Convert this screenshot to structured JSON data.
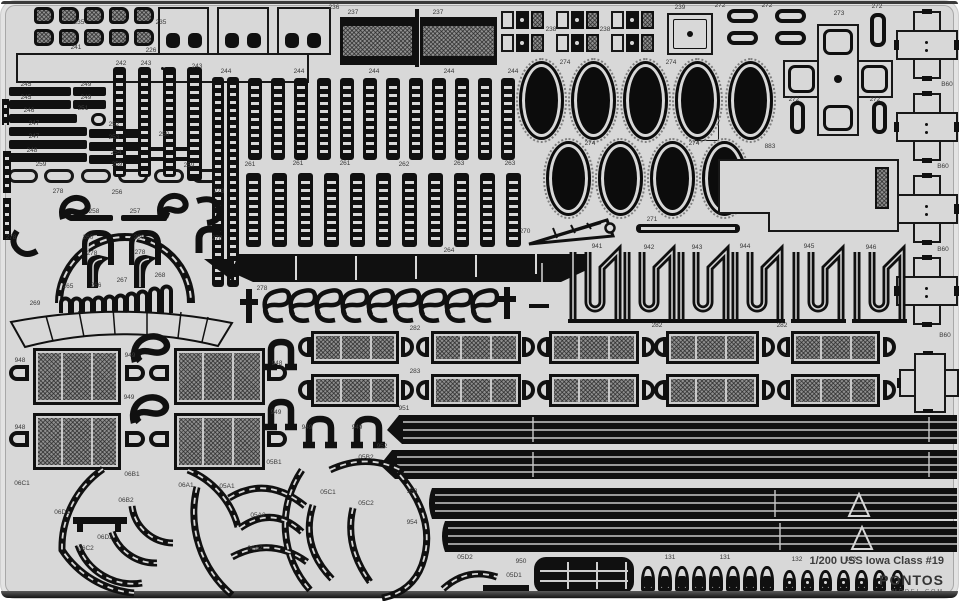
{
  "sheet": {
    "title": "1/200 USS Iowa Class #19",
    "brand": "PONTOS",
    "brand_sub": "MODEL.COM",
    "bg_color": "#d8d8d8",
    "part_color": "#101010",
    "mesh_color": "#8f8f8f"
  },
  "labels": [
    {
      "t": "235",
      "x": 78,
      "y": 22
    },
    {
      "t": "235",
      "x": 160,
      "y": 22
    },
    {
      "t": "226",
      "x": 150,
      "y": 50
    },
    {
      "t": "241",
      "x": 75,
      "y": 47
    },
    {
      "t": "236",
      "x": 333,
      "y": 7
    },
    {
      "t": "237",
      "x": 352,
      "y": 12
    },
    {
      "t": "237",
      "x": 437,
      "y": 12
    },
    {
      "t": "238",
      "x": 550,
      "y": 29
    },
    {
      "t": "238",
      "x": 604,
      "y": 29
    },
    {
      "t": "239",
      "x": 679,
      "y": 7
    },
    {
      "t": "272",
      "x": 719,
      "y": 5
    },
    {
      "t": "272",
      "x": 766,
      "y": 5
    },
    {
      "t": "272",
      "x": 876,
      "y": 6
    },
    {
      "t": "273",
      "x": 838,
      "y": 13
    },
    {
      "t": "272",
      "x": 793,
      "y": 99
    },
    {
      "t": "272",
      "x": 874,
      "y": 99
    },
    {
      "t": "B60",
      "x": 946,
      "y": 84
    },
    {
      "t": "B60",
      "x": 942,
      "y": 166
    },
    {
      "t": "B60",
      "x": 942,
      "y": 249
    },
    {
      "t": "B60",
      "x": 944,
      "y": 335
    },
    {
      "t": "274",
      "x": 564,
      "y": 62
    },
    {
      "t": "274",
      "x": 670,
      "y": 62
    },
    {
      "t": "274",
      "x": 589,
      "y": 143
    },
    {
      "t": "274",
      "x": 693,
      "y": 143
    },
    {
      "t": "883",
      "x": 769,
      "y": 146
    },
    {
      "t": "242",
      "x": 120,
      "y": 63
    },
    {
      "t": "243",
      "x": 145,
      "y": 63
    },
    {
      "t": "243",
      "x": 196,
      "y": 66
    },
    {
      "t": "244",
      "x": 225,
      "y": 71
    },
    {
      "t": "244",
      "x": 298,
      "y": 71
    },
    {
      "t": "244",
      "x": 373,
      "y": 71
    },
    {
      "t": "244",
      "x": 448,
      "y": 71
    },
    {
      "t": "244",
      "x": 512,
      "y": 71
    },
    {
      "t": "245",
      "x": 25,
      "y": 84
    },
    {
      "t": "249",
      "x": 85,
      "y": 84
    },
    {
      "t": "245",
      "x": 25,
      "y": 97
    },
    {
      "t": "249",
      "x": 85,
      "y": 97
    },
    {
      "t": "246",
      "x": 28,
      "y": 110
    },
    {
      "t": "251",
      "x": 82,
      "y": 108
    },
    {
      "t": "247",
      "x": 33,
      "y": 123
    },
    {
      "t": "252",
      "x": 113,
      "y": 124
    },
    {
      "t": "247",
      "x": 33,
      "y": 136
    },
    {
      "t": "253",
      "x": 113,
      "y": 137
    },
    {
      "t": "248",
      "x": 31,
      "y": 150
    },
    {
      "t": "254",
      "x": 115,
      "y": 152
    },
    {
      "t": "250",
      "x": 163,
      "y": 134
    },
    {
      "t": "259",
      "x": 40,
      "y": 164
    },
    {
      "t": "259",
      "x": 116,
      "y": 164
    },
    {
      "t": "259",
      "x": 188,
      "y": 165
    },
    {
      "t": "261",
      "x": 249,
      "y": 164
    },
    {
      "t": "261",
      "x": 297,
      "y": 163
    },
    {
      "t": "261",
      "x": 344,
      "y": 163
    },
    {
      "t": "262",
      "x": 403,
      "y": 164
    },
    {
      "t": "263",
      "x": 458,
      "y": 163
    },
    {
      "t": "263",
      "x": 509,
      "y": 163
    },
    {
      "t": "256",
      "x": 116,
      "y": 192
    },
    {
      "t": "257",
      "x": 134,
      "y": 211
    },
    {
      "t": "258",
      "x": 93,
      "y": 211
    },
    {
      "t": "260",
      "x": 87,
      "y": 237
    },
    {
      "t": "260",
      "x": 138,
      "y": 237
    },
    {
      "t": "278",
      "x": 57,
      "y": 191
    },
    {
      "t": "278",
      "x": 218,
      "y": 191
    },
    {
      "t": "278",
      "x": 10,
      "y": 237
    },
    {
      "t": "278",
      "x": 216,
      "y": 238
    },
    {
      "t": "278",
      "x": 91,
      "y": 253
    },
    {
      "t": "278",
      "x": 139,
      "y": 252
    },
    {
      "t": "278",
      "x": 261,
      "y": 288
    },
    {
      "t": "265",
      "x": 67,
      "y": 286
    },
    {
      "t": "266",
      "x": 95,
      "y": 285
    },
    {
      "t": "267",
      "x": 121,
      "y": 280
    },
    {
      "t": "268",
      "x": 159,
      "y": 275
    },
    {
      "t": "269",
      "x": 34,
      "y": 303
    },
    {
      "t": "264",
      "x": 448,
      "y": 250
    },
    {
      "t": "270",
      "x": 524,
      "y": 231
    },
    {
      "t": "271",
      "x": 651,
      "y": 219
    },
    {
      "t": "941",
      "x": 596,
      "y": 246
    },
    {
      "t": "942",
      "x": 648,
      "y": 247
    },
    {
      "t": "943",
      "x": 696,
      "y": 247
    },
    {
      "t": "944",
      "x": 744,
      "y": 246
    },
    {
      "t": "945",
      "x": 808,
      "y": 246
    },
    {
      "t": "946",
      "x": 870,
      "y": 247
    },
    {
      "t": "948",
      "x": 19,
      "y": 360
    },
    {
      "t": "948",
      "x": 276,
      "y": 363
    },
    {
      "t": "948",
      "x": 19,
      "y": 427
    },
    {
      "t": "949",
      "x": 129,
      "y": 355
    },
    {
      "t": "949",
      "x": 128,
      "y": 397
    },
    {
      "t": "949",
      "x": 275,
      "y": 412
    },
    {
      "t": "949",
      "x": 306,
      "y": 427
    },
    {
      "t": "949",
      "x": 356,
      "y": 427
    },
    {
      "t": "282",
      "x": 414,
      "y": 328
    },
    {
      "t": "282",
      "x": 656,
      "y": 325
    },
    {
      "t": "282",
      "x": 781,
      "y": 325
    },
    {
      "t": "283",
      "x": 414,
      "y": 371
    },
    {
      "t": "951",
      "x": 403,
      "y": 408
    },
    {
      "t": "952",
      "x": 381,
      "y": 446
    },
    {
      "t": "953",
      "x": 411,
      "y": 491
    },
    {
      "t": "954",
      "x": 411,
      "y": 522
    },
    {
      "t": "950",
      "x": 520,
      "y": 561
    },
    {
      "t": "06C1",
      "x": 21,
      "y": 483
    },
    {
      "t": "06B1",
      "x": 131,
      "y": 474
    },
    {
      "t": "06B2",
      "x": 125,
      "y": 500
    },
    {
      "t": "06D1",
      "x": 61,
      "y": 512
    },
    {
      "t": "06D2",
      "x": 104,
      "y": 537
    },
    {
      "t": "06C2",
      "x": 85,
      "y": 548
    },
    {
      "t": "06A1",
      "x": 185,
      "y": 485
    },
    {
      "t": "05A1",
      "x": 226,
      "y": 486
    },
    {
      "t": "05A2",
      "x": 257,
      "y": 515
    },
    {
      "t": "06A2",
      "x": 254,
      "y": 548
    },
    {
      "t": "05B1",
      "x": 273,
      "y": 462
    },
    {
      "t": "05B2",
      "x": 365,
      "y": 457
    },
    {
      "t": "05C1",
      "x": 327,
      "y": 492
    },
    {
      "t": "05C2",
      "x": 365,
      "y": 503
    },
    {
      "t": "05D2",
      "x": 464,
      "y": 557
    },
    {
      "t": "05D1",
      "x": 513,
      "y": 575
    },
    {
      "t": "131",
      "x": 669,
      "y": 557
    },
    {
      "t": "131",
      "x": 724,
      "y": 557
    },
    {
      "t": "132",
      "x": 796,
      "y": 559
    },
    {
      "t": "132",
      "x": 850,
      "y": 559
    }
  ]
}
